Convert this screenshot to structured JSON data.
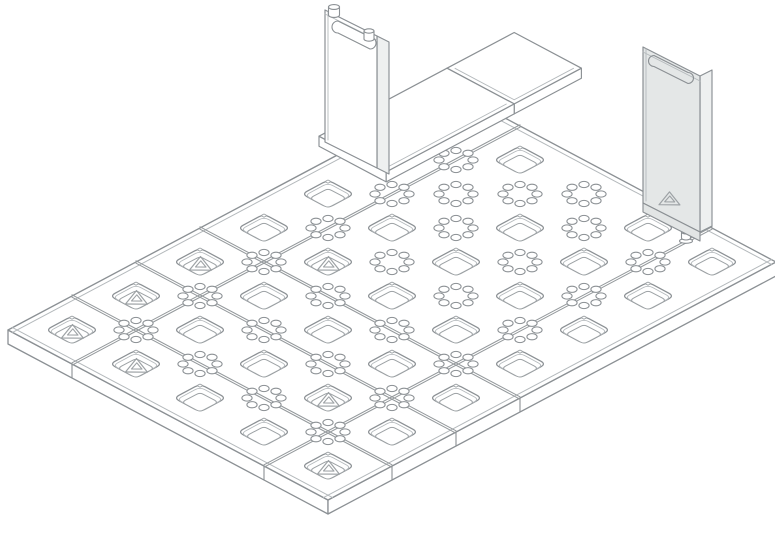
{
  "scene": {
    "width": 775,
    "height": 545,
    "background": "#ffffff"
  },
  "colors": {
    "line": "#8b9094",
    "line_soft": "#9da2a5",
    "line_light": "#b4b9bc",
    "seam": "#94999c",
    "white": "#ffffff",
    "panel_face": "#e4e7e7",
    "panel_fin": "#eef0f0",
    "foot_face": "#e2e5e5"
  },
  "floor": {
    "origin": [
      8,
      330
    ],
    "u": [
      64,
      34
    ],
    "v": [
      64,
      -34
    ],
    "cols": 5,
    "rows": 7,
    "thickness": 14,
    "edge_inset": 0.07,
    "u_seams": [
      1,
      2,
      3
    ],
    "v_seams": [
      1,
      4
    ],
    "blank_cells": [
      [
        0,
        5
      ],
      [
        0,
        6
      ],
      [
        1,
        5
      ],
      [
        2,
        6
      ]
    ],
    "logo_cells": [
      [
        0,
        0
      ],
      [
        0,
        1
      ],
      [
        0,
        2
      ],
      [
        1,
        0
      ],
      [
        1,
        3
      ],
      [
        3,
        1
      ],
      [
        4,
        0
      ]
    ],
    "pocket": {
      "hw": 26,
      "hh": 14,
      "corner": 0.2,
      "rim_scale": 0.88,
      "rim_dy": 1.4,
      "floor_scale": 0.7,
      "floor_dy": 4.2,
      "notch": 3
    },
    "ring": {
      "rx": 17,
      "ry": 9.5,
      "holes": 8,
      "hole_rx": 5.1,
      "hole_ry": 3.1
    }
  },
  "cover_plate": {
    "c": [
      -0.42,
      7.28
    ],
    "da": 1.05,
    "db": 1.05,
    "t": 10
  },
  "bracket": {
    "base": {
      "c": [
        -0.42,
        5.28
      ],
      "da": 1.05,
      "db": 2.0,
      "t": 10
    },
    "upright": {
      "face": [
        [
          325,
          10
        ],
        [
          377,
          36
        ],
        [
          377,
          168
        ],
        [
          325,
          142
        ]
      ],
      "fin": [
        [
          377,
          36
        ],
        [
          389,
          42
        ],
        [
          389,
          174
        ],
        [
          377,
          168
        ]
      ],
      "slot": {
        "a": [
          338,
          27
        ],
        "b": [
          370,
          43
        ],
        "r": 6
      },
      "pins": [
        {
          "cx": 334,
          "top": 7,
          "r": 5.5,
          "h": 8,
          "ry": 2.4
        },
        {
          "cx": 369,
          "top": 31,
          "r": 5.0,
          "h": 8,
          "ry": 2.2
        }
      ]
    }
  },
  "panel": {
    "face": [
      [
        643,
        47
      ],
      [
        700,
        76
      ],
      [
        700,
        232
      ],
      [
        643,
        203
      ]
    ],
    "fin": [
      [
        700,
        76
      ],
      [
        712,
        70
      ],
      [
        712,
        226
      ],
      [
        700,
        232
      ]
    ],
    "slot": {
      "a": [
        654,
        61
      ],
      "b": [
        688,
        78
      ],
      "r": 5.5
    },
    "logo_center": [
      669,
      199
    ],
    "foot": [
      [
        643,
        203
      ],
      [
        700,
        232
      ],
      [
        700,
        241
      ],
      [
        643,
        212
      ]
    ],
    "pin": {
      "cx": 686,
      "top": 232,
      "r": 4.5,
      "h": 6,
      "ry": 2.0
    },
    "pad": {
      "cx": 686,
      "cy": 241,
      "rx": 6.5,
      "ry": 2.3
    }
  },
  "logo_glyph": {
    "outer": [
      [
        -10.5,
        6
      ],
      [
        0.5,
        -7.5
      ],
      [
        11.5,
        6.2
      ]
    ],
    "inner": [
      [
        -4.5,
        3
      ],
      [
        0.8,
        -3.2
      ],
      [
        6,
        3.1
      ]
    ]
  }
}
